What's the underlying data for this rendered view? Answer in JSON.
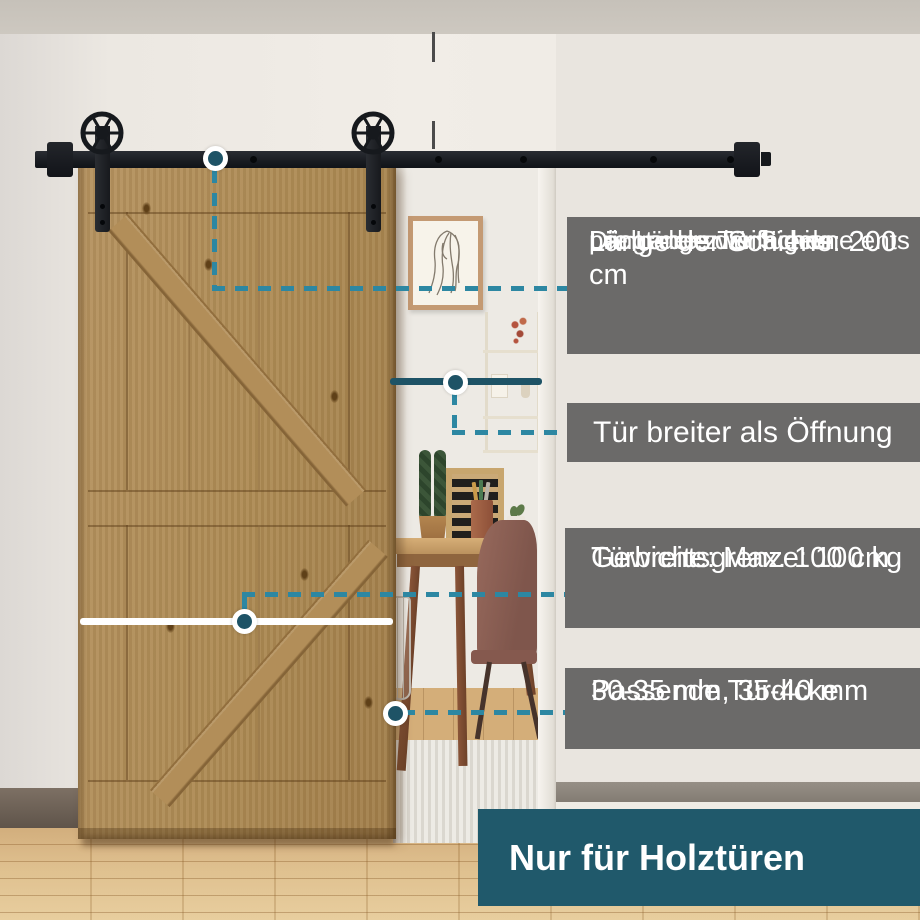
{
  "callouts": {
    "rail_length": {
      "title": "Länge der Schiene: 200 cm",
      "description_lines": [
        "Die Länge der Schiene ents",
        "pricht der zweifachen",
        "Länge des Türflügels"
      ]
    },
    "door_wider": {
      "label": "Tür breiter als Öffnung"
    },
    "weight_limit": {
      "line1": "Gewichtsgrenze: 100 kg",
      "line2": "Türbreite: Max. 100 cm"
    },
    "door_thickness": {
      "line1": "Passende Türdicke",
      "line2": "30-35 mm, 35-40 mm"
    },
    "banner": {
      "label": "Nur für Holztüren"
    }
  },
  "colors": {
    "callout_box_gray": "#6b6a69",
    "banner_teal": "#20596b",
    "dot_teal": "#1e5366",
    "dash_teal": "#2d87a2",
    "text_white": "#ffffff"
  },
  "icons": {
    "roller-wheel-icon": "six-spoke wheel circle",
    "callout-dot-icon": "white-ringed teal dot"
  }
}
